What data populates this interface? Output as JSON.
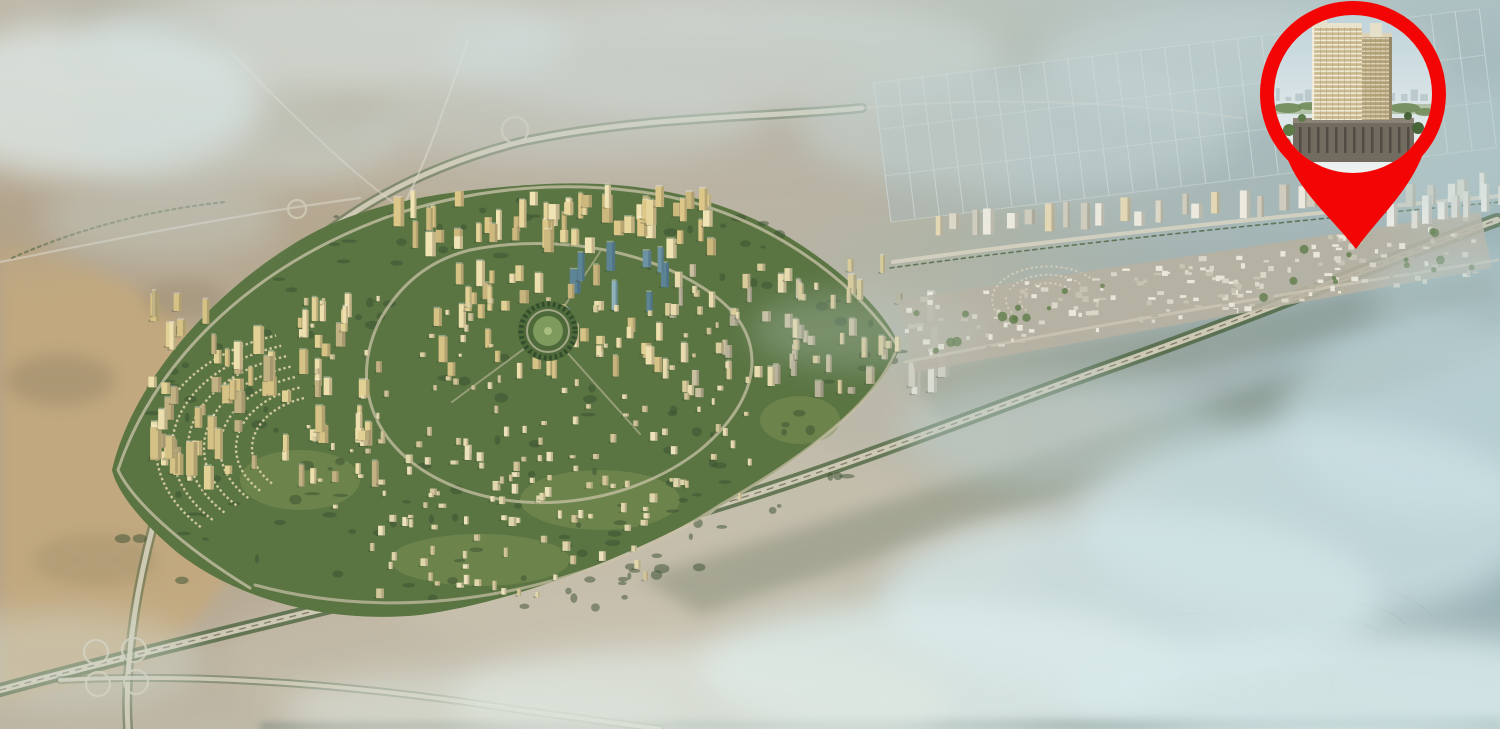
{
  "scene": {
    "width": 1500,
    "height": 729
  },
  "background": {
    "h": [
      [
        0,
        "#b2a28a"
      ],
      [
        0.22,
        "#b7ab95"
      ],
      [
        0.45,
        "#bdb5a4"
      ],
      [
        0.62,
        "#b0b4a6"
      ],
      [
        0.8,
        "#a3b3b2"
      ],
      [
        1,
        "#97afb4"
      ]
    ],
    "v": [
      [
        0,
        "#cfdcda",
        0.38
      ],
      [
        0.32,
        "#cfdcda",
        0
      ],
      [
        0.78,
        "#d5dfda",
        0
      ],
      [
        1,
        "#d5dfda",
        0.3
      ]
    ]
  },
  "terrain": {
    "shapes": [
      {
        "t": "p",
        "d": "M0,240 C120,262 222,332 252,420 C272,500 242,602 142,662 L0,702 Z",
        "f": "#c4a97d",
        "o": 0.85,
        "b": 8
      },
      {
        "t": "p",
        "d": "M0,120 C150,142 300,172 420,202 L420,262 C250,252 100,262 0,282 Z",
        "f": "#b3a48c",
        "o": 0.55,
        "b": 16
      },
      {
        "t": "e",
        "cx": 60,
        "cy": 380,
        "rx": 55,
        "ry": 26,
        "f": "#8e7f63",
        "o": 0.4,
        "b": 8
      },
      {
        "t": "e",
        "cx": 185,
        "cy": 300,
        "rx": 42,
        "ry": 20,
        "f": "#8e7f63",
        "o": 0.3,
        "b": 8
      },
      {
        "t": "e",
        "cx": 95,
        "cy": 560,
        "rx": 62,
        "ry": 26,
        "f": "#9a8a68",
        "o": 0.35,
        "b": 8
      },
      {
        "t": "e",
        "cx": 140,
        "cy": 32,
        "rx": 85,
        "ry": 26,
        "f": "#8a8878",
        "o": 0.4,
        "b": 16
      },
      {
        "t": "e",
        "cx": 330,
        "cy": 118,
        "rx": 75,
        "ry": 22,
        "f": "#998c74",
        "o": 0.3,
        "b": 16
      },
      {
        "t": "e",
        "cx": 700,
        "cy": 560,
        "rx": 330,
        "ry": 120,
        "f": "#cec7b4",
        "o": 0.5,
        "b": 16
      },
      {
        "t": "e",
        "cx": 920,
        "cy": 470,
        "rx": 260,
        "ry": 100,
        "f": "#c6beae",
        "o": 0.45,
        "b": 16
      },
      {
        "t": "e",
        "cx": 700,
        "cy": 150,
        "rx": 320,
        "ry": 90,
        "f": "#b9b0a0",
        "o": 0.5,
        "b": 16
      },
      {
        "t": "e",
        "cx": 1250,
        "cy": 170,
        "rx": 260,
        "ry": 80,
        "f": "#adbdbd",
        "o": 0.4,
        "b": 16
      },
      {
        "t": "e",
        "cx": 480,
        "cy": 660,
        "rx": 260,
        "ry": 80,
        "f": "#c9c2b0",
        "o": 0.45,
        "b": 16
      }
    ],
    "fields": {
      "rot": -7,
      "cx": 1160,
      "cy": 120,
      "x": 880,
      "y": 48,
      "w": 610,
      "h": 140,
      "cols": 26,
      "rows": 4,
      "base": "#a9bbbd",
      "baseO": 0.42,
      "line": "#e6edee",
      "lineO": 0.5
    },
    "ghost": {
      "c": "#7e9593",
      "w": 1.4,
      "o": 0.32,
      "squash": 0.6,
      "arcs": [
        {
          "cx": 1190,
          "cy": 700,
          "radii": [
            55,
            85,
            115,
            145
          ],
          "a0": 185,
          "a1": 355
        },
        {
          "cx": 1345,
          "cy": 645,
          "radii": [
            40,
            70,
            100
          ],
          "a0": 165,
          "a1": 330
        }
      ],
      "rects": {
        "n": 30,
        "x": 1000,
        "y": 545,
        "w": 420,
        "h": 95
      }
    },
    "corridors": [
      {
        "d": "M640,578 L1500,312 L1500,354 L700,614 Z",
        "f": "#66745f",
        "o": 0.32,
        "b": 8
      },
      {
        "d": "M908,374 L1492,270 L1500,302 L942,422 Z",
        "f": "#707e6a",
        "o": 0.28,
        "b": 8
      },
      {
        "d": "M260,724 L1500,714 L1500,729 L260,729 Z",
        "f": "#3f5b55",
        "o": 0.5,
        "b": 4
      }
    ]
  },
  "roads": [
    {
      "d": "M0,690 C200,636 430,586 640,528 C820,478 960,420 1100,370 C1260,314 1380,262 1497,220",
      "c": "#47603a",
      "w": 14,
      "o": 0.75
    },
    {
      "d": "M0,690 C200,636 430,586 640,528 C820,478 960,420 1100,370 C1260,314 1380,262 1497,220",
      "c": "#d3ccb8",
      "w": 6.5,
      "o": 0.95
    },
    {
      "d": "M0,690 C200,636 430,586 640,528 C820,478 960,420 1100,370 C1260,314 1380,262 1497,220",
      "c": "#6e6a58",
      "w": 1.3,
      "o": 0.8,
      "dash": "6 7"
    },
    {
      "d": "M128,729 C122,640 150,470 235,330 C300,232 402,172 520,142 C640,116 760,118 862,108",
      "c": "#4a6440",
      "w": 10,
      "o": 0.5
    },
    {
      "d": "M128,729 C122,640 150,470 235,330 C300,232 402,172 520,142 C640,116 760,118 862,108",
      "c": "#d6d0bd",
      "w": 5,
      "o": 0.9
    },
    {
      "d": "M60,680 C220,672 380,688 520,710 C580,718 620,724 660,729",
      "c": "#4a6440",
      "w": 8,
      "o": 0.45
    },
    {
      "d": "M60,680 C220,672 380,688 520,710 C580,718 620,724 660,729",
      "c": "#d6d0bd",
      "w": 4,
      "o": 0.85
    },
    {
      "d": "M395,222 C428,162 448,96 468,40",
      "c": "#dcd8cc",
      "w": 2,
      "o": 0.6
    },
    {
      "d": "M230,52 C298,120 348,170 398,206",
      "c": "#d8d4c6",
      "w": 2,
      "o": 0.55
    },
    {
      "d": "M0,262 C120,238 240,214 360,198",
      "c": "#d8d4c6",
      "w": 2.2,
      "o": 0.6
    },
    {
      "d": "M862,108 C1000,96 1120,102 1242,118",
      "c": "#d3d2c6",
      "w": 2,
      "o": 0.5
    },
    {
      "d": "M12,258 C80,228 150,210 225,202",
      "c": "#3f5a35",
      "w": 2.2,
      "o": 0.5,
      "dash": "3 4"
    },
    {
      "d": "M630,522 C662,542 700,527 718,506",
      "c": "#cbc4ae",
      "w": 2,
      "o": 0.6
    }
  ],
  "interchanges": {
    "c": "#d0c9b4",
    "w": 2.3,
    "o": 0.85,
    "circles": [
      [
        96,
        652,
        12
      ],
      [
        134,
        650,
        12
      ],
      [
        98,
        684,
        12
      ],
      [
        136,
        682,
        12
      ],
      [
        648,
        517,
        15
      ],
      [
        704,
        499,
        12
      ],
      [
        515,
        130,
        13
      ],
      [
        297,
        209,
        9
      ]
    ]
  },
  "city": {
    "outline": "M112,470 C130,392 200,300 300,240 C360,204 440,190 545,184 C640,180 720,196 790,238 C850,275 890,318 900,348 C878,400 800,462 710,512 C620,560 515,602 420,615 C330,624 238,600 178,553 C148,528 118,496 112,470 Z",
    "green": "#5a7442",
    "lightPatches": [
      [
        300,
        480,
        60,
        30
      ],
      [
        600,
        500,
        80,
        30
      ],
      [
        800,
        420,
        40,
        24
      ],
      [
        480,
        560,
        90,
        26
      ]
    ],
    "lightC": "#7d9455",
    "treeC": "#39502f",
    "treeRegions": [
      [
        250,
        520,
        130,
        66,
        22
      ],
      [
        520,
        560,
        150,
        48,
        22
      ],
      [
        760,
        470,
        92,
        58,
        16
      ],
      [
        200,
        380,
        82,
        62,
        16
      ],
      [
        430,
        230,
        120,
        30,
        14
      ],
      [
        700,
        250,
        84,
        36,
        12
      ],
      [
        852,
        340,
        52,
        42,
        10
      ],
      [
        560,
        430,
        160,
        80,
        20
      ],
      [
        330,
        300,
        70,
        40,
        10
      ],
      [
        640,
        545,
        110,
        35,
        14
      ]
    ],
    "villaArcs": {
      "cx": 330,
      "cy": 448,
      "radii": [
        78,
        94,
        110,
        126,
        142,
        158,
        174
      ],
      "a0": 138,
      "a1": 252,
      "squash": 0.68,
      "c": "#dbcfa6",
      "w": 2.4,
      "dash": "2.5 2.6",
      "o": 0.9
    },
    "roads": [
      {
        "d": "M250,588 C180,545 132,500 118,470 C150,372 240,270 390,216 C480,186 570,180 655,194 C760,212 850,275 897,345",
        "c": "#ccc4aa",
        "w": 3,
        "o": 0.75
      },
      {
        "d": "M255,585 C420,630 600,585 720,505 C820,448 880,395 897,348",
        "c": "#cac2a8",
        "w": 3,
        "o": 0.7
      },
      {
        "d": "M470,250 C560,232 660,252 720,300 C770,342 760,400 700,450 C630,505 520,520 440,480 C370,445 350,380 380,320 C405,276 438,258 470,250 Z",
        "c": "#cfc7ad",
        "w": 3,
        "o": 0.7
      },
      {
        "d": "M548,331 L640,434",
        "c": "#cfc7ad",
        "w": 2,
        "o": 0.5
      },
      {
        "d": "M548,331 L452,402",
        "c": "#cfc7ad",
        "w": 2,
        "o": 0.5
      },
      {
        "d": "M548,331 L600,252",
        "c": "#cfc7ad",
        "w": 2,
        "o": 0.5
      }
    ],
    "clusters": [
      {
        "x": 380,
        "y": 205,
        "w": 330,
        "h": 55,
        "n": 55,
        "w1": 5,
        "w2": 11,
        "h1": 12,
        "h2": 30,
        "pal": [
          "#f1e4b4",
          "#e7d69c",
          "#dcc688",
          "#cdb97e"
        ],
        "sh": "#8a7c5a"
      },
      {
        "x": 548,
        "y": 255,
        "w": 120,
        "h": 75,
        "n": 9,
        "w1": 6,
        "w2": 11,
        "h1": 16,
        "h2": 36,
        "pal": [
          "#7fa2b0",
          "#6d93a2",
          "#90b2bc",
          "#5d8495"
        ],
        "sh": "#3f606e"
      },
      {
        "x": 430,
        "y": 280,
        "w": 230,
        "h": 100,
        "n": 45,
        "w1": 5,
        "w2": 10,
        "h1": 8,
        "h2": 26,
        "pal": [
          "#eedfae",
          "#e2d194",
          "#d5c284",
          "#c6b47c"
        ],
        "sh": "#8a7c5a"
      },
      {
        "x": 148,
        "y": 310,
        "w": 230,
        "h": 180,
        "n": 75,
        "w1": 5,
        "w2": 11,
        "h1": 8,
        "h2": 28,
        "pal": [
          "#eedfae",
          "#e2d194",
          "#d5c284",
          "#c2b183"
        ],
        "sh": "#857758"
      },
      {
        "x": 150,
        "y": 420,
        "w": 90,
        "h": 60,
        "n": 10,
        "w1": 7,
        "w2": 12,
        "h1": 20,
        "h2": 36,
        "pal": [
          "#ecdfae",
          "#e0cf97",
          "#d3c186"
        ],
        "sh": "#857758"
      },
      {
        "x": 660,
        "y": 270,
        "w": 240,
        "h": 130,
        "n": 65,
        "w1": 4,
        "w2": 9,
        "h1": 6,
        "h2": 20,
        "pal": [
          "#e8dcae",
          "#d9cc9b",
          "#c9c0a0",
          "#b8b29a"
        ],
        "sh": "#7b7460"
      },
      {
        "x": 370,
        "y": 430,
        "w": 310,
        "h": 170,
        "n": 85,
        "w1": 4,
        "w2": 8,
        "h1": 4,
        "h2": 10,
        "pal": [
          "#ece2bc",
          "#e0d6ac",
          "#d2c69a"
        ],
        "sh": "#8d8164"
      },
      {
        "x": 300,
        "y": 300,
        "w": 460,
        "h": 220,
        "n": 90,
        "w1": 3,
        "w2": 6,
        "h1": 3,
        "h2": 8,
        "pal": [
          "#e7dcb2",
          "#dbd0a2",
          "#cfc497"
        ],
        "sh": "#8d8164"
      },
      {
        "x": 893,
        "y": 300,
        "w": 45,
        "h": 95,
        "n": 6,
        "w1": 8,
        "w2": 12,
        "h1": 20,
        "h2": 34,
        "pal": [
          "#ecebe2",
          "#dfdfd4",
          "#d0cfc2"
        ],
        "sh": "#8a8a7c"
      }
    ],
    "park": {
      "cx": 548,
      "cy": 331,
      "r": 30,
      "green": "#4e6a3a",
      "ring": "#2f482a",
      "inner": "#7e9a5c",
      "path": "#c9c2a8",
      "dot": "#a9bd7e"
    }
  },
  "strip": {
    "band": "M898,300 L1480,212 L1492,268 L915,372 Z",
    "bandFill": "#b7b2a2",
    "bandO": 0.88,
    "roads": [
      {
        "d": "M893,262 C1080,236 1300,214 1500,196",
        "c": "#d8d3c2",
        "w": 4,
        "o": 0.85
      },
      {
        "d": "M890,268 C1080,242 1300,220 1500,202",
        "c": "#3f5a35",
        "w": 1.6,
        "o": 0.7,
        "dash": "4 4"
      },
      {
        "d": "M905,362 C1100,324 1320,288 1498,260",
        "c": "#cfc9b6",
        "w": 3,
        "o": 0.7
      }
    ],
    "arcs": {
      "cx": 1048,
      "cy": 300,
      "radii": [
        28,
        42,
        56
      ],
      "a0": 140,
      "a1": 325,
      "squash": 0.6,
      "c": "#d6d0bc",
      "w": 2,
      "dash": "2.5 2.5",
      "o": 0.8
    },
    "blocks": {
      "ax": 905,
      "ay": 335,
      "bx": 1478,
      "by": 248,
      "off1": -36,
      "off2": 24,
      "n": 230,
      "w1": 3,
      "w2": 8,
      "h1": 2,
      "h2": 6,
      "pal": [
        "#e9e6da",
        "#dad6c8",
        "#c7c3b2",
        "#b5b2a2"
      ]
    },
    "greens": {
      "ax": 905,
      "ay": 338,
      "bx": 1478,
      "by": 251,
      "off1": -30,
      "off2": 18,
      "n": 26,
      "r1": 2,
      "r2": 5,
      "c": "#5f7b49",
      "o": 0.8
    },
    "towers": [
      {
        "ax": 930,
        "ay": 235,
        "bx": 1482,
        "by": 200,
        "n": 30,
        "w1": 6,
        "w2": 12,
        "h1": 14,
        "h2": 28,
        "pal": [
          "#eceadf",
          "#dcd8c8",
          "#cfccbd",
          "#e3d7b4"
        ],
        "sh": "#8a8878"
      },
      {
        "ax": 1392,
        "ay": 228,
        "bx": 1498,
        "by": 208,
        "n": 8,
        "w1": 7,
        "w2": 12,
        "h1": 16,
        "h2": 30,
        "pal": [
          "#f0eee6",
          "#e2e0d6"
        ],
        "sh": "#8a8878"
      }
    ]
  },
  "hazes": [
    [
      90,
      100,
      170,
      80,
      "#dde7e5",
      0.8
    ],
    [
      330,
      40,
      240,
      55,
      "#d6e1df",
      0.6
    ],
    [
      720,
      55,
      280,
      60,
      "#d0dcda",
      0.55
    ],
    [
      1020,
      130,
      220,
      60,
      "#c6d6d6",
      0.5
    ],
    [
      1240,
      60,
      200,
      55,
      "#cadada",
      0.5
    ],
    [
      1445,
      150,
      130,
      70,
      "#bcd2d4",
      0.45
    ],
    [
      1450,
      420,
      170,
      100,
      "#c4dade",
      0.7
    ],
    [
      1310,
      520,
      230,
      100,
      "#cde2e5",
      0.75
    ],
    [
      1130,
      600,
      250,
      90,
      "#d2e4e6",
      0.8
    ],
    [
      940,
      670,
      240,
      70,
      "#dcebea",
      0.8
    ],
    [
      700,
      700,
      250,
      55,
      "#e0e8e2",
      0.7
    ],
    [
      480,
      710,
      200,
      40,
      "#dde4dc",
      0.55
    ],
    [
      1340,
      690,
      280,
      60,
      "#d8e9ea",
      0.85
    ],
    [
      60,
      660,
      140,
      50,
      "#d5dfd8",
      0.4
    ],
    [
      1490,
      300,
      120,
      60,
      "#b8cdd0",
      0.5
    ],
    [
      240,
      140,
      160,
      50,
      "#cfdbd9",
      0.45
    ],
    [
      560,
      120,
      200,
      45,
      "#ccd8d6",
      0.4
    ],
    [
      870,
      330,
      120,
      40,
      "#bfcfc9",
      0.3
    ],
    [
      1060,
      430,
      160,
      60,
      "#bdd2d2",
      0.45
    ],
    [
      160,
      220,
      120,
      40,
      "#c8d4d0",
      0.4
    ]
  ],
  "pin": {
    "red": "#f30505",
    "cx": 1353,
    "cy": 94,
    "r": 93,
    "photoR": 79,
    "tail": "M1356,249 C1328,213 1291,186 1282,140 L1428,138 C1416,186 1382,213 1356,249 Z"
  },
  "photo": {
    "sky1": "#bfd3da",
    "sky2": "#eef2f0",
    "horizon": 101,
    "horizonC": "#dfe8e8",
    "skyline": {
      "n": 16,
      "x1": 1276,
      "x2": 1430,
      "c": "#b6c5c9"
    },
    "greenBand": {
      "x": 1276,
      "y": 104,
      "w": 156,
      "h": 10,
      "c": "#87a06a",
      "o": 0.5
    },
    "greens": [
      [
        1288,
        108,
        14,
        5
      ],
      [
        1310,
        106,
        12,
        4
      ],
      [
        1340,
        107,
        16,
        4
      ],
      [
        1375,
        106,
        14,
        4
      ],
      [
        1405,
        108,
        15,
        5
      ],
      [
        1425,
        112,
        10,
        4
      ]
    ],
    "greenC": "#6f8a57",
    "podium": {
      "x": 1293,
      "y": 118,
      "w": 121,
      "h": 44,
      "f": "#716b60",
      "top": "#8a8376",
      "slit": "#4a443c",
      "shadow": "#4c463e"
    },
    "towerA": {
      "x": 1312,
      "y": 26,
      "w": 50,
      "h": 94
    },
    "towerB": {
      "x": 1360,
      "y": 36,
      "w": 32,
      "h": 84
    },
    "bodyA": "#cbb98e",
    "slabA": "#f2ecda",
    "mullA": "#a89670",
    "bodyB": "#b3a17a",
    "slabB": "#ddd3b5",
    "parapetA": "#e9e2cc",
    "parapetB": "#dcd3b8",
    "edgeShade": "#96886a",
    "highlight": "#f7f2e2",
    "roofBoxes": [
      [
        1316,
        17,
        11,
        10
      ],
      [
        1370,
        23,
        12,
        14
      ]
    ],
    "roofC": "#e6dfc9",
    "trees": [
      [
        1289,
        130,
        6
      ],
      [
        1284,
        144,
        7
      ],
      [
        1296,
        157,
        6
      ],
      [
        1418,
        128,
        6
      ],
      [
        1424,
        143,
        7
      ],
      [
        1410,
        158,
        6
      ],
      [
        1302,
        118,
        4
      ],
      [
        1408,
        116,
        4
      ]
    ],
    "treeC": "#5d7a49",
    "treeC2": "#476338"
  }
}
